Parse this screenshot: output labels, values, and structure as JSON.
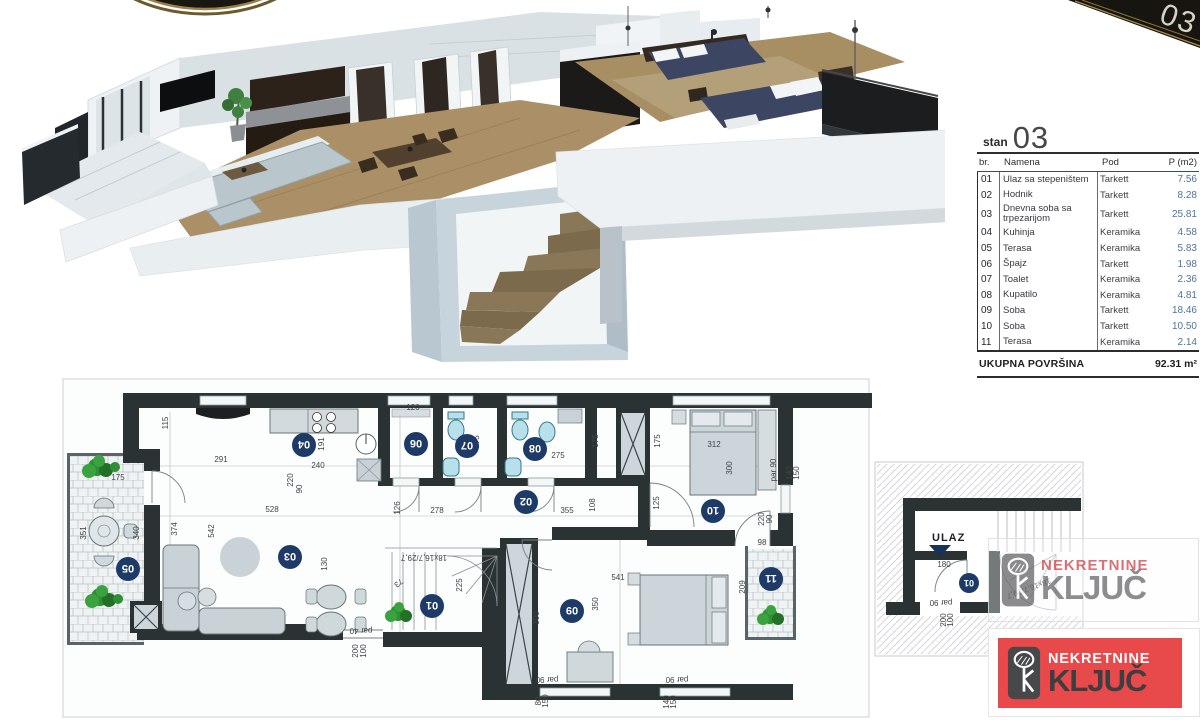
{
  "corner_ribbon": {
    "number": "03"
  },
  "unit_table": {
    "unit_label": "stan",
    "unit_number": "03",
    "columns": [
      "br.",
      "Namena",
      "Pod",
      "P (m2)"
    ],
    "rows": [
      {
        "br": "01",
        "namena": "Ulaz sa stepeništem",
        "pod": "Tarkett",
        "p": "7.56"
      },
      {
        "br": "02",
        "namena": "Hodnik",
        "pod": "Tarkett",
        "p": "8.28"
      },
      {
        "br": "03",
        "namena": "Dnevna soba sa trpezarijom",
        "pod": "Tarkett",
        "p": "25.81"
      },
      {
        "br": "04",
        "namena": "Kuhinja",
        "pod": "Keramika",
        "p": "4.58"
      },
      {
        "br": "05",
        "namena": "Terasa",
        "pod": "Keramika",
        "p": "5.83"
      },
      {
        "br": "06",
        "namena": "Špajz",
        "pod": "Tarkett",
        "p": "1.98"
      },
      {
        "br": "07",
        "namena": "Toalet",
        "pod": "Keramika",
        "p": "2.36"
      },
      {
        "br": "08",
        "namena": "Kupatilo",
        "pod": "Keramika",
        "p": "4.81"
      },
      {
        "br": "09",
        "namena": "Soba",
        "pod": "Tarkett",
        "p": "18.46"
      },
      {
        "br": "10",
        "namena": "Soba",
        "pod": "Tarkett",
        "p": "10.50"
      },
      {
        "br": "11",
        "namena": "Terasa",
        "pod": "Keramika",
        "p": "2.14"
      }
    ],
    "total_label": "UKUPNA POVRŠINA",
    "total_value": "92.31 m²"
  },
  "floorplan": {
    "badges": [
      {
        "n": "01",
        "x": 432,
        "y": 606
      },
      {
        "n": "02",
        "x": 526,
        "y": 502
      },
      {
        "n": "03",
        "x": 290,
        "y": 557
      },
      {
        "n": "04",
        "x": 304,
        "y": 445
      },
      {
        "n": "05",
        "x": 128,
        "y": 569
      },
      {
        "n": "06",
        "x": 416,
        "y": 444
      },
      {
        "n": "07",
        "x": 467,
        "y": 446
      },
      {
        "n": "08",
        "x": 535,
        "y": 449
      },
      {
        "n": "09",
        "x": 572,
        "y": 611
      },
      {
        "n": "10",
        "x": 713,
        "y": 511
      },
      {
        "n": "11",
        "x": 771,
        "y": 579
      }
    ],
    "dims": [
      {
        "t": "115",
        "x": 168,
        "y": 423,
        "a": -90
      },
      {
        "t": "291",
        "x": 221,
        "y": 462,
        "a": 0
      },
      {
        "t": "240",
        "x": 318,
        "y": 468,
        "a": 0
      },
      {
        "t": "191",
        "x": 324,
        "y": 444,
        "a": -90
      },
      {
        "t": "120",
        "x": 413,
        "y": 410,
        "a": 0
      },
      {
        "t": "135",
        "x": 466,
        "y": 456,
        "a": 0
      },
      {
        "t": "175",
        "x": 479,
        "y": 442,
        "a": -90
      },
      {
        "t": "275",
        "x": 558,
        "y": 458,
        "a": 0
      },
      {
        "t": "175",
        "x": 598,
        "y": 441,
        "a": -90
      },
      {
        "t": "175",
        "x": 660,
        "y": 441,
        "a": -90
      },
      {
        "t": "175",
        "x": 118,
        "y": 480,
        "a": 0
      },
      {
        "t": "220",
        "x": 293,
        "y": 480,
        "a": -90
      },
      {
        "t": "90",
        "x": 302,
        "y": 489,
        "a": -90
      },
      {
        "t": "528",
        "x": 272,
        "y": 512,
        "a": 0
      },
      {
        "t": "374",
        "x": 177,
        "y": 529,
        "a": -90
      },
      {
        "t": "542",
        "x": 214,
        "y": 531,
        "a": -90
      },
      {
        "t": "351",
        "x": 86,
        "y": 533,
        "a": -90
      },
      {
        "t": "340",
        "x": 139,
        "y": 533,
        "a": -90
      },
      {
        "t": "130",
        "x": 327,
        "y": 564,
        "a": -90
      },
      {
        "t": "278",
        "x": 437,
        "y": 513,
        "a": 0
      },
      {
        "t": "126",
        "x": 400,
        "y": 508,
        "a": -90
      },
      {
        "t": "355",
        "x": 567,
        "y": 513,
        "a": 0
      },
      {
        "t": "108",
        "x": 595,
        "y": 505,
        "a": -90
      },
      {
        "t": "312",
        "x": 714,
        "y": 447,
        "a": 0
      },
      {
        "t": "300",
        "x": 732,
        "y": 468,
        "a": -90
      },
      {
        "t": "125",
        "x": 659,
        "y": 503,
        "a": -90
      },
      {
        "t": "98",
        "x": 762,
        "y": 545,
        "a": 0
      },
      {
        "t": "220",
        "x": 764,
        "y": 519,
        "a": -90
      },
      {
        "t": "90",
        "x": 772,
        "y": 519,
        "a": -90
      },
      {
        "t": "par 90",
        "x": 776,
        "y": 470,
        "a": -90
      },
      {
        "t": "140",
        "x": 792,
        "y": 473,
        "a": -90
      },
      {
        "t": "150",
        "x": 799,
        "y": 473,
        "a": -90
      },
      {
        "t": "541",
        "x": 618,
        "y": 580,
        "a": 0
      },
      {
        "t": "350",
        "x": 598,
        "y": 604,
        "a": -90
      },
      {
        "t": "300",
        "x": 539,
        "y": 618,
        "a": -90
      },
      {
        "t": "209",
        "x": 745,
        "y": 587,
        "a": -90
      },
      {
        "t": "73",
        "x": 397,
        "y": 581,
        "a": 140
      },
      {
        "t": "225",
        "x": 462,
        "y": 585,
        "a": -90
      },
      {
        "t": "par 40",
        "x": 361,
        "y": 628,
        "a": 180
      },
      {
        "t": "100",
        "x": 366,
        "y": 651,
        "a": -90
      },
      {
        "t": "200",
        "x": 358,
        "y": 651,
        "a": -90
      },
      {
        "t": "par 90",
        "x": 547,
        "y": 677,
        "a": 180
      },
      {
        "t": "80",
        "x": 541,
        "y": 701,
        "a": -90
      },
      {
        "t": "150",
        "x": 548,
        "y": 701,
        "a": -90
      },
      {
        "t": "par 90",
        "x": 677,
        "y": 677,
        "a": 180
      },
      {
        "t": "140",
        "x": 669,
        "y": 702,
        "a": -90
      },
      {
        "t": "150",
        "x": 676,
        "y": 702,
        "a": -90
      },
      {
        "t": "18x16,7/29,7",
        "x": 424,
        "y": 555,
        "a": 180
      }
    ]
  },
  "entrance_plan": {
    "ulaz_label": "ULAZ",
    "badge": {
      "n": "01",
      "x": 969,
      "y": 583
    },
    "dims": [
      {
        "t": "180",
        "x": 944,
        "y": 567,
        "a": 0
      },
      {
        "t": "par 90",
        "x": 941,
        "y": 600,
        "a": 180
      },
      {
        "t": "100",
        "x": 953,
        "y": 620,
        "a": -90
      },
      {
        "t": "200",
        "x": 946,
        "y": 620,
        "a": -90
      },
      {
        "t": "18x16,7/29,7",
        "x": 1028,
        "y": 586,
        "a": 160
      }
    ]
  },
  "watermark": {
    "line1": "NEKRETNINE",
    "line2": "KLJUČ"
  },
  "agency_logo": {
    "line1": "NEKRETNINE",
    "line2": "KLJUČ",
    "red": "#e8494a"
  },
  "colors": {
    "wall": "#2b3234",
    "badge": "#1e3a66",
    "fixture": "#b8e0ea",
    "value_blue": "#51739e"
  }
}
